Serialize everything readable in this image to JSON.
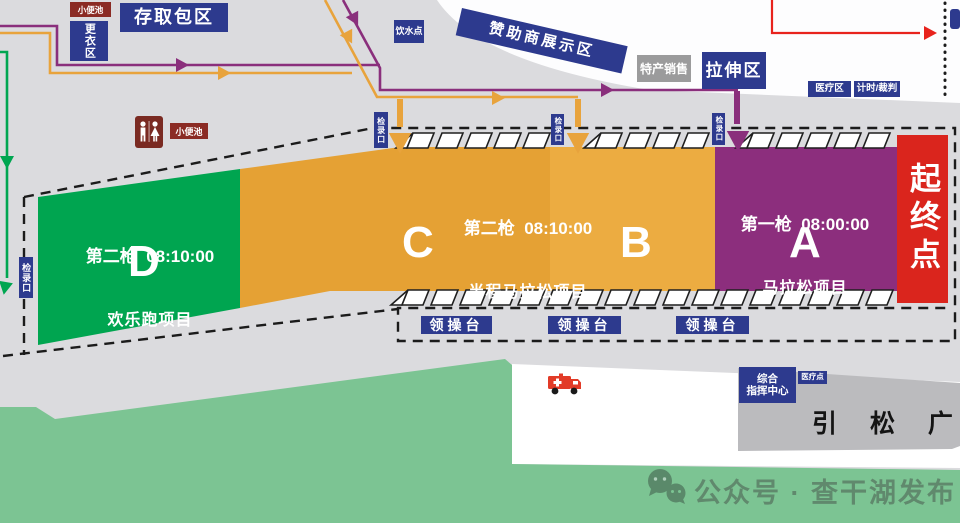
{
  "top_left": {
    "urinal": "小便池",
    "bag_storage": "存取包区",
    "changing_room": "更衣区"
  },
  "top": {
    "water_point": "饮水点",
    "sponsor_display": "赞助商展示区",
    "specialty_sales": "特产销售",
    "stretching_area": "拉伸区",
    "medical_area": "医疗区",
    "timing_referee": "计时/裁判"
  },
  "restroom": {
    "label": "小便池"
  },
  "checkin": {
    "label": "检录口"
  },
  "zones": {
    "d": {
      "line1": "第二枪  08:10:00",
      "line2": "欢乐跑项目",
      "letter": "D"
    },
    "cb": {
      "line1": "第二枪  08:10:00",
      "line2": "半程马拉松项目",
      "letter_c": "C",
      "letter_b": "B"
    },
    "a": {
      "line1": "第一枪  08:00:00",
      "line2": "马拉松项目",
      "letter": "A"
    },
    "start_finish": "起终点"
  },
  "podium": {
    "label": "领操台"
  },
  "bottom": {
    "command_line1": "综合",
    "command_line2": "指挥中心",
    "medical_point": "医疗点",
    "square": "引 松 广 场"
  },
  "watermark": {
    "text": "公众号 · 查干湖发布"
  },
  "colors": {
    "blue": "#2D3A8E",
    "maroon": "#8B2B24",
    "zone_d": "#00A550",
    "zone_c": "#E5A134",
    "zone_b": "#ECAC41",
    "zone_a": "#8C2E7D",
    "start_red": "#DA251D",
    "grass": "#7CC493",
    "road_white": "#FFFFFF",
    "plaza_white": "#FDFDFE",
    "square_gray": "#BBBBBE",
    "route_orange": "#E8A33C",
    "route_purple": "#8A2F7C",
    "route_green": "#00A651",
    "route_red": "#E8231D"
  }
}
